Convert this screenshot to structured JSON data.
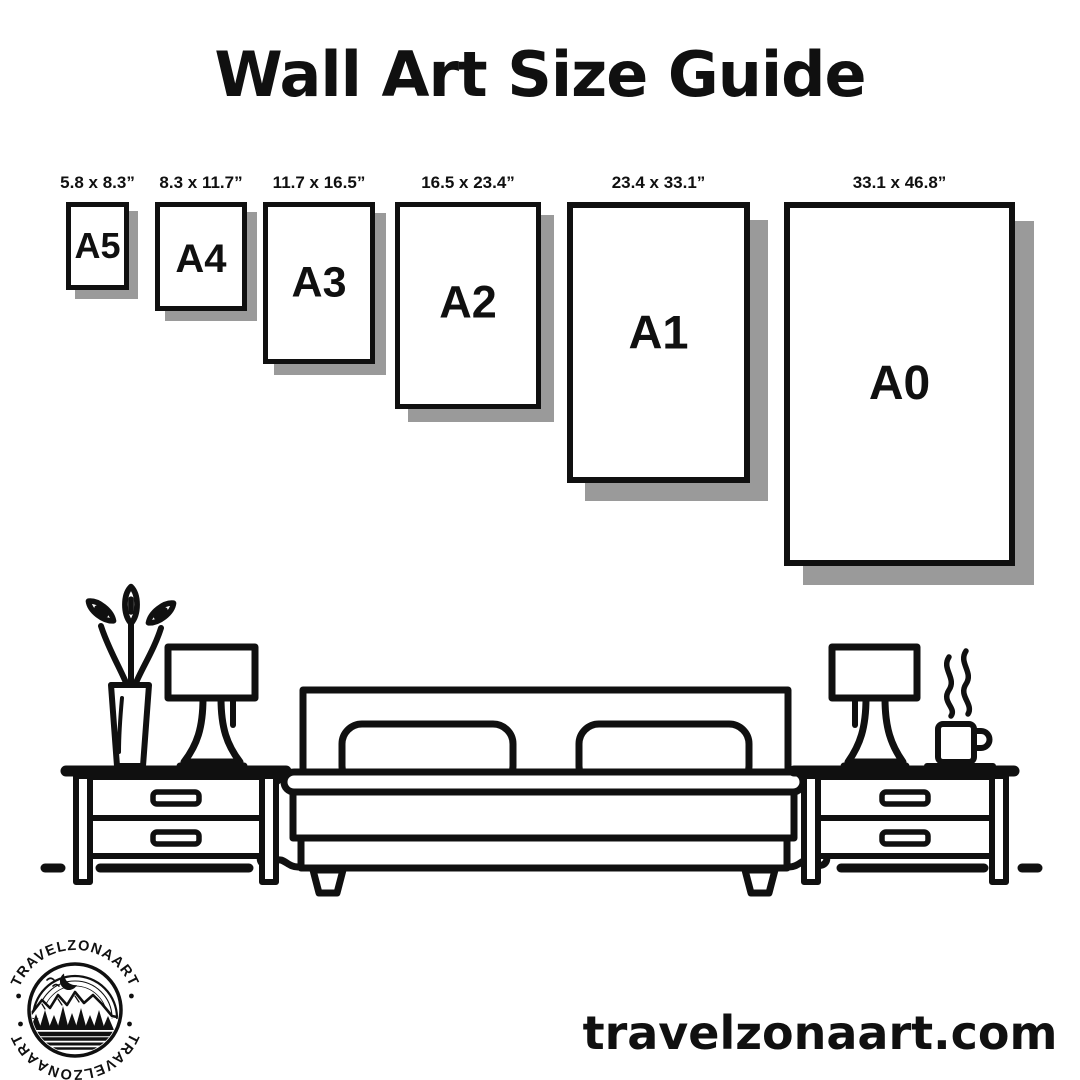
{
  "title": "Wall Art Size Guide",
  "colors": {
    "ink": "#101010",
    "shadow": "#9a9a9a",
    "background": "#ffffff"
  },
  "size_guide": {
    "papers": [
      {
        "name": "A5",
        "dimensions": "5.8 x 8.3”"
      },
      {
        "name": "A4",
        "dimensions": "8.3 x 11.7”"
      },
      {
        "name": "A3",
        "dimensions": "11.7 x 16.5”"
      },
      {
        "name": "A2",
        "dimensions": "16.5 x 23.4”"
      },
      {
        "name": "A1",
        "dimensions": "23.4 x 33.1”"
      },
      {
        "name": "A0",
        "dimensions": "33.1 x 46.8”"
      }
    ]
  },
  "illustration": {
    "icons": [
      "potted-plant",
      "table-lamp",
      "nightstand",
      "double-bed",
      "nightstand",
      "table-lamp",
      "steaming-coffee-cup"
    ]
  },
  "logo": {
    "arc_text_top": "TRAVELZONAART",
    "arc_text_bottom": "TRAVELZONAART"
  },
  "footer": {
    "website": "travelzonaart.com"
  }
}
